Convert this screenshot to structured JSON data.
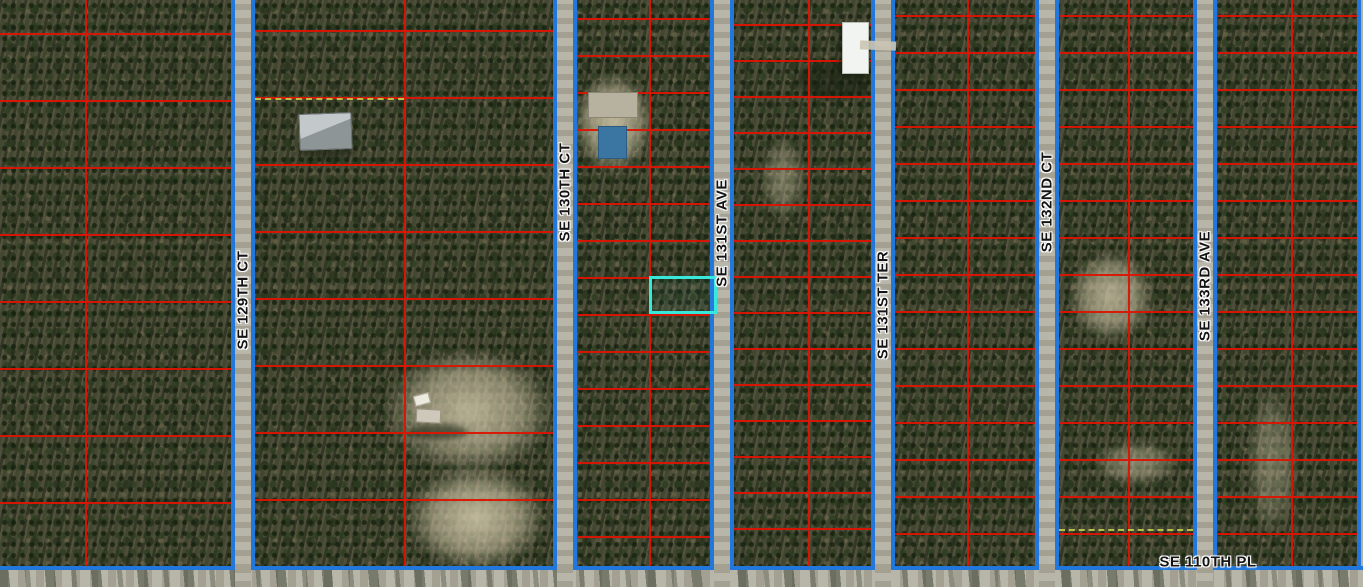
{
  "map": {
    "width": 1363,
    "height": 587,
    "grid_bottom": 566,
    "road_half_width": 12,
    "colors": {
      "parcel_line_red": "#dd1402",
      "block_boundary_blue": "#2277dd",
      "highlight_cyan": "#38e8da",
      "road_surface_gray": "#b3b0a4",
      "dashed_lot_line": "#c3cc4b",
      "label_text": "#141414",
      "label_halo": "#ffffff",
      "forest_base": "#53523e",
      "clearing_sand": "#d5cbad"
    },
    "roads": [
      {
        "id": "se-129th-ct",
        "name": "SE 129TH CT",
        "orientation": "vertical",
        "center": 243,
        "label_center": 300
      },
      {
        "id": "se-130th-ct",
        "name": "SE 130TH CT",
        "orientation": "vertical",
        "center": 565,
        "label_center": 192
      },
      {
        "id": "se-131st-ave",
        "name": "SE 131ST AVE",
        "orientation": "vertical",
        "center": 722,
        "label_center": 233
      },
      {
        "id": "se-131st-ter",
        "name": "SE 131ST TER",
        "orientation": "vertical",
        "center": 883,
        "label_center": 305
      },
      {
        "id": "se-132nd-ct",
        "name": "SE 132ND CT",
        "orientation": "vertical",
        "center": 1047,
        "label_center": 202
      },
      {
        "id": "se-133rd-ave",
        "name": "SE 133RD AVE",
        "orientation": "vertical",
        "center": 1205,
        "label_center": 286
      },
      {
        "id": "se-110th-pl",
        "name": "SE 110TH PL",
        "orientation": "horizontal",
        "center": 576,
        "label_center": 1208
      }
    ],
    "blocks": [
      {
        "id": "block-1",
        "x0": 0,
        "x1": 231,
        "mid_red": 85,
        "row_start": 33,
        "row_spacing": 67
      },
      {
        "id": "block-2",
        "x0": 255,
        "x1": 553,
        "mid_red": 404,
        "row_start": 30,
        "row_spacing": 67,
        "dashed_rows": [
          {
            "y": 98,
            "x0": 255,
            "x1": 404
          }
        ]
      },
      {
        "id": "block-3",
        "x0": 577,
        "x1": 710,
        "mid_red": 649,
        "row_start": 18,
        "row_spacing": 37
      },
      {
        "id": "block-4",
        "x0": 734,
        "x1": 871,
        "mid_red": 808,
        "row_start": 24,
        "row_spacing": 36
      },
      {
        "id": "block-5",
        "x0": 895,
        "x1": 1035,
        "mid_red": 967,
        "row_start": 15,
        "row_spacing": 37
      },
      {
        "id": "block-6",
        "x0": 1059,
        "x1": 1193,
        "mid_red": 1128,
        "row_start": 15,
        "row_spacing": 37,
        "dashed_rows": [
          {
            "y": 529,
            "x0": 1059,
            "x1": 1193
          }
        ]
      },
      {
        "id": "block-7",
        "x0": 1217,
        "x1": 1363,
        "mid_red": 1291,
        "row_start": 15,
        "row_spacing": 37
      }
    ],
    "right_edge_boundary": {
      "x": 1357,
      "y0": 0,
      "y1": 566
    },
    "highlight_parcel": {
      "x": 649,
      "y": 276,
      "w": 68,
      "h": 38
    },
    "clearings": [
      {
        "x": 573,
        "y": 72,
        "w": 80,
        "h": 102,
        "opacity": 0.9
      },
      {
        "x": 383,
        "y": 348,
        "w": 172,
        "h": 126,
        "opacity": 0.85
      },
      {
        "x": 405,
        "y": 465,
        "w": 142,
        "h": 106,
        "opacity": 0.9
      },
      {
        "x": 1068,
        "y": 250,
        "w": 86,
        "h": 92,
        "opacity": 0.8
      },
      {
        "x": 1093,
        "y": 440,
        "w": 86,
        "h": 46,
        "opacity": 0.55
      },
      {
        "x": 760,
        "y": 135,
        "w": 46,
        "h": 86,
        "opacity": 0.45
      },
      {
        "x": 1246,
        "y": 385,
        "w": 52,
        "h": 152,
        "opacity": 0.45
      }
    ],
    "shadows": [
      {
        "x": 798,
        "y": 60,
        "w": 74,
        "h": 40
      },
      {
        "x": 296,
        "y": 141,
        "w": 60,
        "h": 17
      },
      {
        "x": 408,
        "y": 424,
        "w": 60,
        "h": 16
      }
    ],
    "structures": [
      {
        "kind": "gray-roof-house",
        "x": 299,
        "y": 113,
        "w": 53,
        "h": 37,
        "rot": -2
      },
      {
        "kind": "trailer",
        "x": 588,
        "y": 92,
        "w": 50,
        "h": 26,
        "rot": 0
      },
      {
        "kind": "pool",
        "x": 598,
        "y": 126,
        "w": 29,
        "h": 33,
        "rot": 0
      },
      {
        "kind": "white-building",
        "x": 842,
        "y": 22,
        "w": 27,
        "h": 52,
        "rot": 0
      },
      {
        "kind": "driveway",
        "x": 860,
        "y": 41,
        "w": 36,
        "h": 9,
        "rot": 2
      },
      {
        "kind": "shed-small",
        "x": 414,
        "y": 394,
        "w": 16,
        "h": 11,
        "rot": -15
      },
      {
        "kind": "shed",
        "x": 416,
        "y": 409,
        "w": 25,
        "h": 14,
        "rot": 3
      }
    ]
  }
}
